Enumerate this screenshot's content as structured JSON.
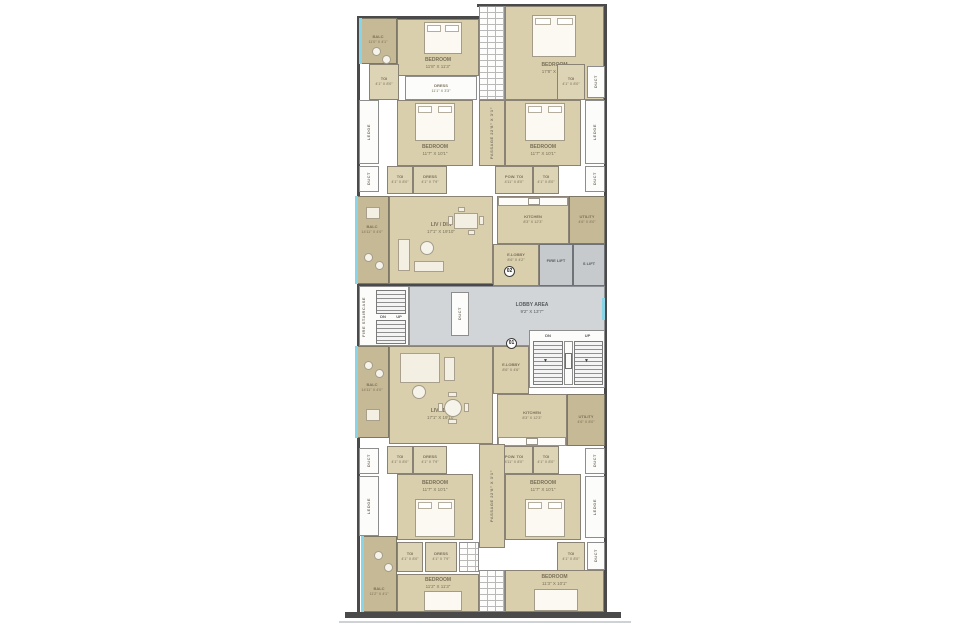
{
  "plan_title": "Typical Floor Plan",
  "badges": {
    "upper_unit": "02",
    "lower_unit": "01"
  },
  "colors": {
    "room_fill": "#d9cfac",
    "balcony_fill": "#c6b995",
    "lobby_fill": "#d2d5d8",
    "lift_fill": "#c6cacd",
    "wall": "#4a4a4a",
    "glazing_blue": "#8ad4e8"
  },
  "rooms": {
    "balc_tl": {
      "name": "BALC",
      "dims": "11'0\" X 4'1\""
    },
    "bed_tl": {
      "name": "BEDROOM",
      "dims": "11'8\" X 11'3\""
    },
    "bed_tr": {
      "name": "BEDROOM",
      "dims": "17'8\" X 10'7\""
    },
    "toi": {
      "name": "TOI",
      "dims": "4'1\" X 8'0\""
    },
    "dress_strip": {
      "name": "DRESS",
      "dims": "11'1\" X 3'3\""
    },
    "dress_small": {
      "name": "DRESS",
      "dims": "4'1\" X 7'9\""
    },
    "pow_toi": {
      "name": "POW. TOI",
      "dims": "4'11\" X 8'0\""
    },
    "passage": {
      "name": "PASSAGE 22'8\" X 3'1\""
    },
    "bed_std": {
      "name": "BEDROOM",
      "dims": "11'7\" X 10'1\""
    },
    "bed_bl": {
      "name": "BEDROOM",
      "dims": "11'2\" X 11'3\""
    },
    "bed_br": {
      "name": "BEDROOM",
      "dims": "11'3\" X 10'1\""
    },
    "balc_liv": {
      "name": "BALC",
      "dims": "14'11\" X 4'0\""
    },
    "balc_bot": {
      "name": "BALC",
      "dims": "11'2\" X 4'1\""
    },
    "livdin": {
      "name": "LIV / DIN",
      "dims": "17'1\" X 19'10\""
    },
    "kitchen": {
      "name": "KITCHEN",
      "dims": "8'3\" X 12'3\""
    },
    "utility": {
      "name": "UTILITY",
      "dims": "4'6\" X 8'0\""
    },
    "elobby_top": {
      "name": "E.LOBBY",
      "dims": "8'6\" X 4'2\""
    },
    "elobby_bot": {
      "name": "E.LOBBY",
      "dims": "8'6\" X 4'6\""
    }
  },
  "core": {
    "lobby": {
      "name": "LOBBY AREA",
      "dims": "9'2\" X 13'7\""
    },
    "fire_staircase": "FIRE STAIRCASE",
    "fire_lift": "FIRE LIFT",
    "s_lift": "S LIFT",
    "duct": "DUCT",
    "ledge": "LEDGE",
    "up": "UP",
    "dn": "DN",
    "down_arrow": "▼"
  }
}
